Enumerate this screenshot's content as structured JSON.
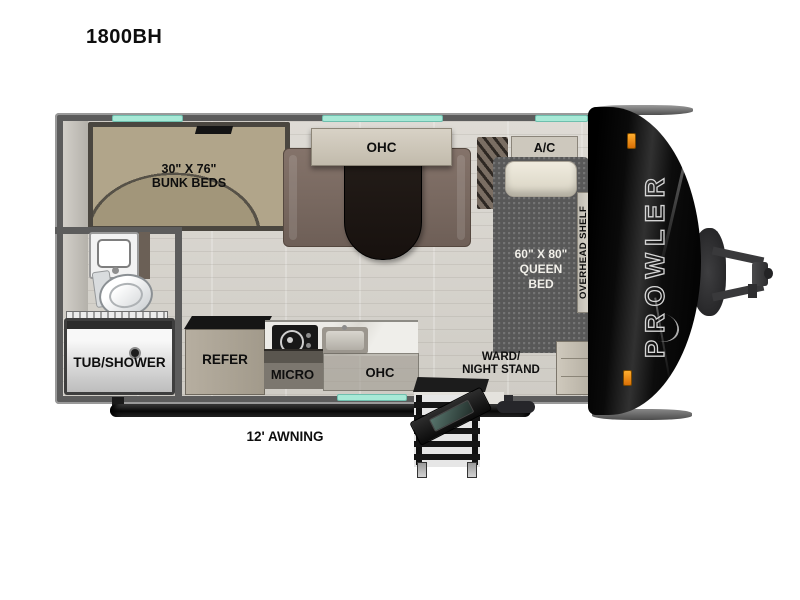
{
  "title": "1800BH",
  "colors": {
    "window_teal": "#a7e9d6",
    "marker_orange": "#e8850f",
    "front_cap_black": "#0b0b0b",
    "wall_gray": "#5c5c5c"
  },
  "floorplan": {
    "brand": "PROWLER",
    "awning": "12' AWNING",
    "bunk_size": "30\" X 76\"",
    "bunk_label": "BUNK BEDS",
    "dinette_ohc": "OHC",
    "ac": "A/C",
    "bed_size": "60\" X 80\"",
    "bed_line2": "QUEEN",
    "bed_line3": "BED",
    "overhead_shelf": "OVERHEAD SHELF",
    "ward_line1": "WARD/",
    "ward_line2": "NIGHT STAND",
    "tub_shower": "TUB/SHOWER",
    "refer": "REFER",
    "micro": "MICRO",
    "kitchen_ohc": "OHC"
  }
}
